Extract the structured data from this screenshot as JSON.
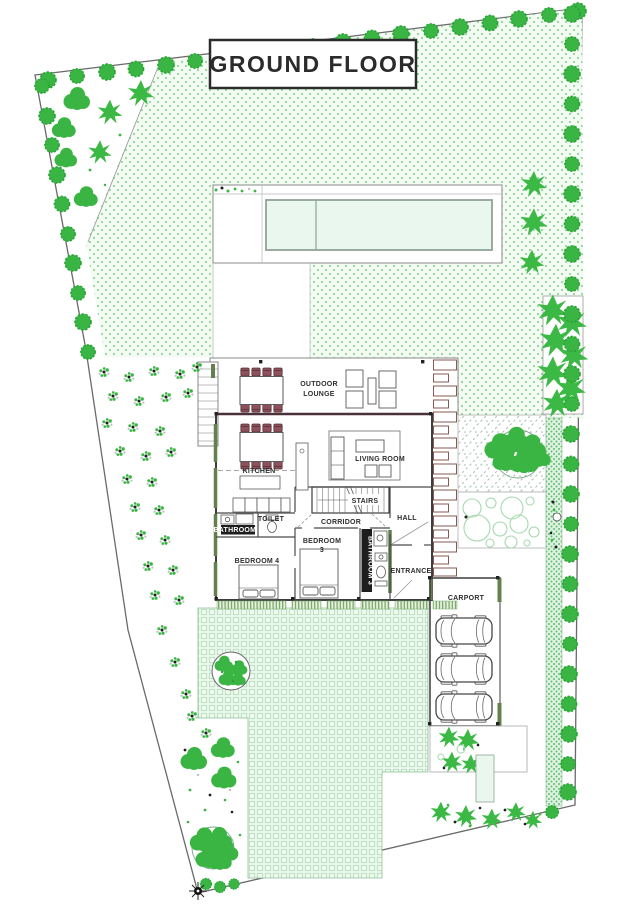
{
  "title": "GROUND FLOOR",
  "rooms": {
    "outdoor_lounge": [
      "OUTDOOR",
      "LOUNGE"
    ],
    "kitchen": "KITCHEN",
    "living_room": "LIVING ROOM",
    "stairs": "STAIRS",
    "corridor": "CORRIDOR",
    "hall": "HALL",
    "bathroom4": "BATHROOM 4",
    "toilet": "TOILET",
    "bedroom4": "BEDROOM 4",
    "bedroom3": [
      "BEDROOM",
      "3"
    ],
    "bathroom3": "BATHROOM 3",
    "entrance": "ENTRANCE",
    "carport": "CARPORT"
  },
  "colors": {
    "tree": "#3cb944",
    "bush": "#3ab543",
    "bushStroke": "#27a334",
    "lawnBg": "#f3fbf3",
    "lawnDot": "#8ed89a",
    "gridBg": "#eef9ef",
    "gridLine": "#aedbb5",
    "hedgeBg": "#dff2e2",
    "hedgeDot": "#5fbe72",
    "pool": "#e9f7ef",
    "poolStroke": "#8fa396",
    "wall": "#3d3d3d",
    "olive": "#64804e",
    "maroon": "#8c515a",
    "maroonDark": "#552e35",
    "trellis": "#8a5a52",
    "label": "#2e2e2e",
    "stripe": "#6c9a58",
    "stripeBg": "#e3f1de",
    "pale": "#a7d9ae"
  }
}
